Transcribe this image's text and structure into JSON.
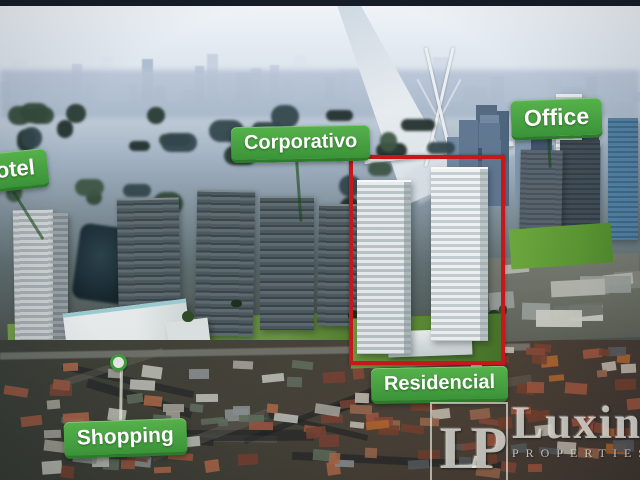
{
  "annotations": {
    "hotel": "Hotel",
    "corporativo": "Corporativo",
    "office": "Office",
    "residencial": "Residencial",
    "shopping": "Shopping"
  },
  "watermark": {
    "monogram": "LP",
    "brand": "Luxin",
    "subtitle": "PROPERTIES"
  },
  "colors": {
    "label_green": "#3f9a3c",
    "label_green_dark": "#2c7a2a",
    "label_text": "#ffffff",
    "highlight_red": "#c8161d"
  },
  "icons": {
    "map_pin_icon": "green ring pin above shopping mall"
  }
}
